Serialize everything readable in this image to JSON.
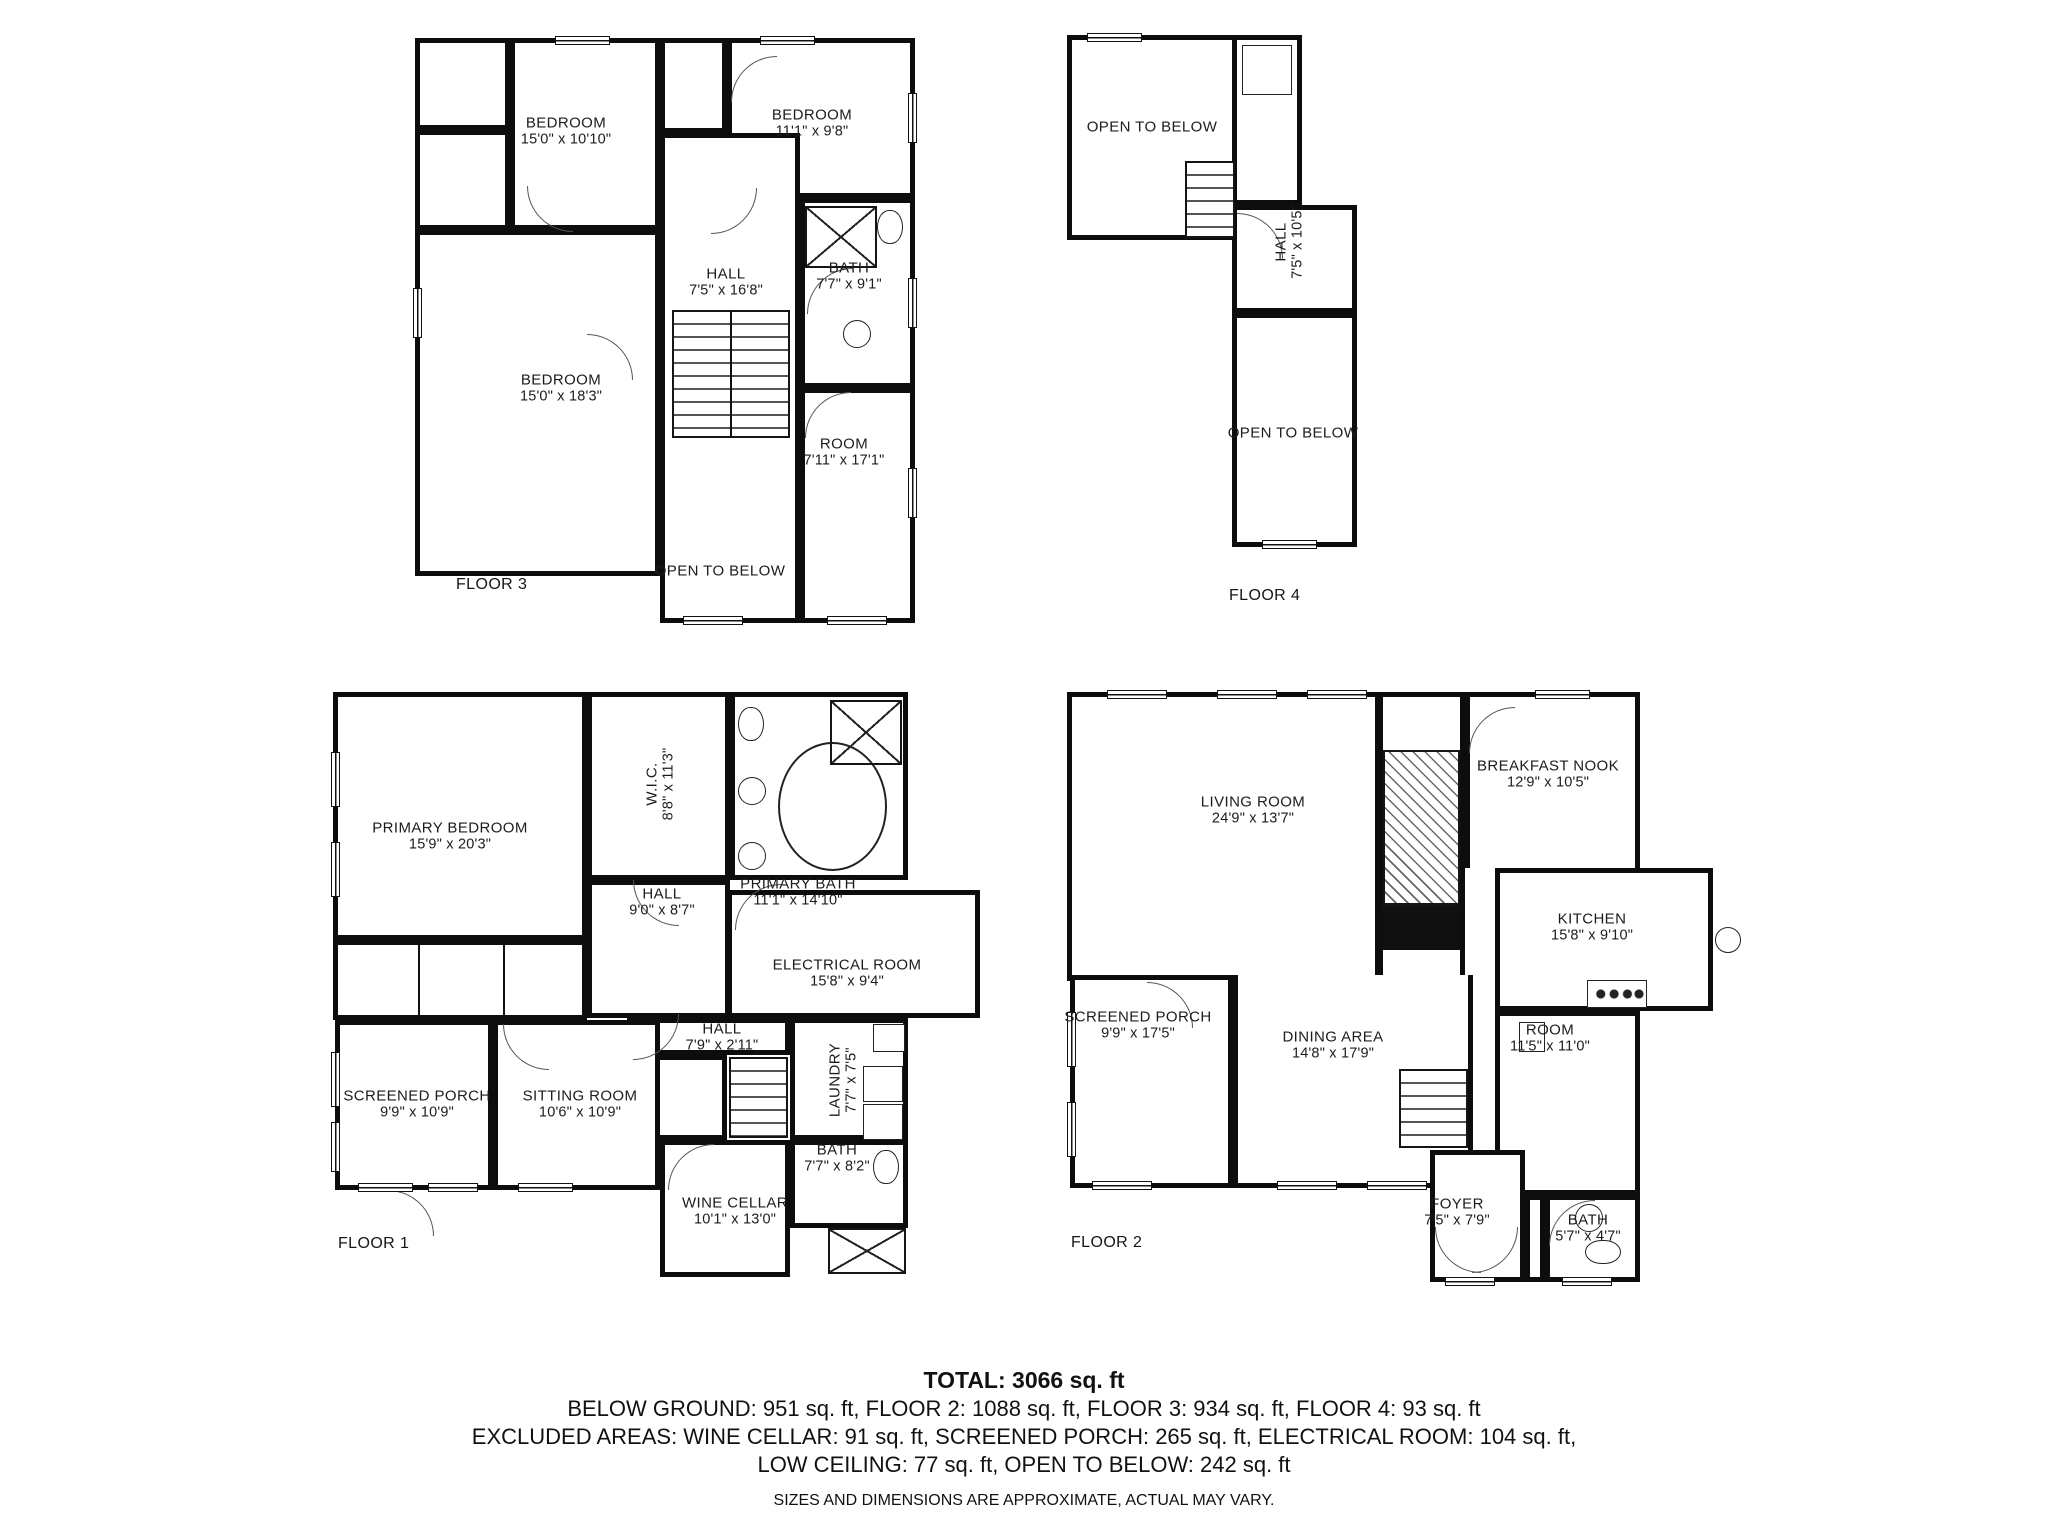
{
  "colors": {
    "wall": "#111111",
    "background": "#ffffff",
    "text": "#1c1c1c"
  },
  "floors": {
    "floor3": {
      "label": "FLOOR 3",
      "rooms": {
        "bedroom1": {
          "name": "BEDROOM",
          "dims": "15'0\" x 10'10\""
        },
        "bedroom2": {
          "name": "BEDROOM",
          "dims": "11'1\" x 9'8\""
        },
        "hall": {
          "name": "HALL",
          "dims": "7'5\" x 16'8\""
        },
        "bath": {
          "name": "BATH",
          "dims": "7'7\" x 9'1\""
        },
        "bedroom3": {
          "name": "BEDROOM",
          "dims": "15'0\" x 18'3\""
        },
        "room": {
          "name": "ROOM",
          "dims": "7'11\" x 17'1\""
        },
        "open_below": {
          "name": "OPEN TO BELOW"
        }
      }
    },
    "floor4": {
      "label": "FLOOR 4",
      "rooms": {
        "open_below_upper": {
          "name": "OPEN TO BELOW"
        },
        "hall": {
          "name": "HALL",
          "dims": "7'5\" x 10'5\""
        },
        "open_below_lower": {
          "name": "OPEN TO BELOW"
        }
      }
    },
    "floor1": {
      "label": "FLOOR 1",
      "rooms": {
        "primary_bedroom": {
          "name": "PRIMARY BEDROOM",
          "dims": "15'9\" x 20'3\""
        },
        "wic": {
          "name": "W.I.C.",
          "dims": "8'8\" x 11'3\""
        },
        "hall": {
          "name": "HALL",
          "dims": "9'0\" x 8'7\""
        },
        "primary_bath": {
          "name": "PRIMARY BATH",
          "dims": "11'1\" x 14'10\""
        },
        "electrical": {
          "name": "ELECTRICAL ROOM",
          "dims": "15'8\" x 9'4\""
        },
        "hall2": {
          "name": "HALL",
          "dims": "7'9\" x 2'11\""
        },
        "laundry": {
          "name": "LAUNDRY",
          "dims": "7'7\" x 7'5\""
        },
        "screened_porch": {
          "name": "SCREENED PORCH",
          "dims": "9'9\" x 10'9\""
        },
        "sitting": {
          "name": "SITTING ROOM",
          "dims": "10'6\" x 10'9\""
        },
        "bath": {
          "name": "BATH",
          "dims": "7'7\" x 8'2\""
        },
        "wine": {
          "name": "WINE CELLAR",
          "dims": "10'1\" x 13'0\""
        }
      }
    },
    "floor2": {
      "label": "FLOOR 2",
      "rooms": {
        "living": {
          "name": "LIVING ROOM",
          "dims": "24'9\" x 13'7\""
        },
        "breakfast": {
          "name": "BREAKFAST NOOK",
          "dims": "12'9\" x 10'5\""
        },
        "kitchen": {
          "name": "KITCHEN",
          "dims": "15'8\" x 9'10\""
        },
        "screened_porch": {
          "name": "SCREENED PORCH",
          "dims": "9'9\" x 17'5\""
        },
        "dining": {
          "name": "DINING AREA",
          "dims": "14'8\" x 17'9\""
        },
        "room": {
          "name": "ROOM",
          "dims": "11'5\" x 11'0\""
        },
        "foyer": {
          "name": "FOYER",
          "dims": "7'5\" x 7'9\""
        },
        "bath": {
          "name": "BATH",
          "dims": "5'7\" x 4'7\""
        }
      }
    }
  },
  "summary": {
    "total": "TOTAL: 3066 sq. ft",
    "line1": "BELOW GROUND: 951 sq. ft, FLOOR 2: 1088 sq. ft, FLOOR 3: 934 sq. ft, FLOOR 4: 93 sq. ft",
    "line2": "EXCLUDED AREAS: WINE CELLAR: 91 sq. ft, SCREENED PORCH: 265 sq. ft, ELECTRICAL ROOM: 104 sq. ft,",
    "line3": "LOW CEILING: 77 sq. ft, OPEN TO BELOW: 242 sq. ft",
    "disclaimer": "SIZES AND DIMENSIONS ARE APPROXIMATE, ACTUAL MAY VARY."
  }
}
